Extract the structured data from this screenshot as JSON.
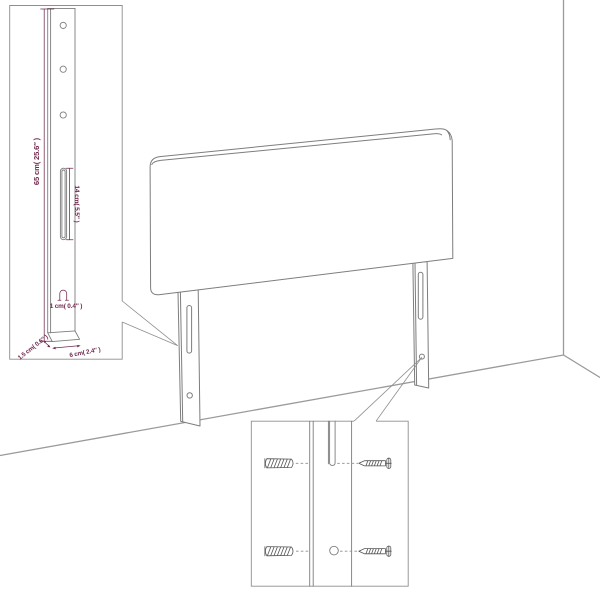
{
  "colors": {
    "background": "#ffffff",
    "artwork_line": "#7d7d7d",
    "room_line": "#9a9a9a",
    "callout_line": "#8e8e8e",
    "hardware_line": "#565656",
    "dimension": "#70294e"
  },
  "leg_detail_inset": {
    "height_label": "65 cm( 25.6″ )",
    "slot_label": "14 cm( 5.5″ )",
    "hole_label": "1 cm( 0.4″ )",
    "thickness_label": "1.5 cm( 0.6″ )",
    "width_label": "6 cm( 2.4″ )"
  },
  "icons": [
    "wall-plug-icon",
    "screw-icon",
    "hole-profile-icon",
    "leg-slot",
    "mounting-hole"
  ]
}
